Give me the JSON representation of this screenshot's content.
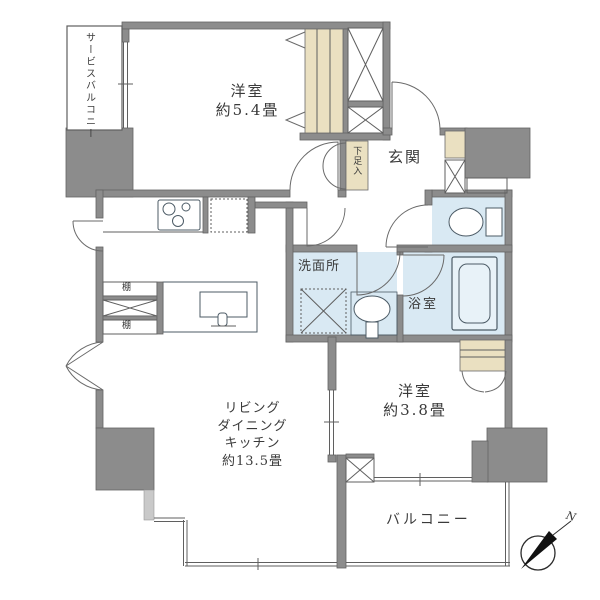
{
  "floorplan": {
    "labels": {
      "service_balcony": "サービスバルコニー",
      "bedroom1_name": "洋室",
      "bedroom1_size": "約5.4畳",
      "shoe_box": "下足入",
      "genkan": "玄関",
      "washroom": "洗面所",
      "bathroom": "浴室",
      "shelf_top": "棚",
      "shelf_bottom": "棚",
      "ldk_line1": "リビング",
      "ldk_line2": "ダイニング",
      "ldk_line3": "キッチン",
      "ldk_size": "約13.5畳",
      "bedroom2_name": "洋室",
      "bedroom2_size": "約3.8畳",
      "balcony": "バルコニー",
      "compass_north": "N"
    },
    "colors": {
      "wall": "#8c8c8c",
      "wet_area": "#d9e9f3",
      "closet": "#eae0c1",
      "step": "#c9c9c9",
      "line": "#5f5f5f",
      "background": "#ffffff"
    }
  }
}
